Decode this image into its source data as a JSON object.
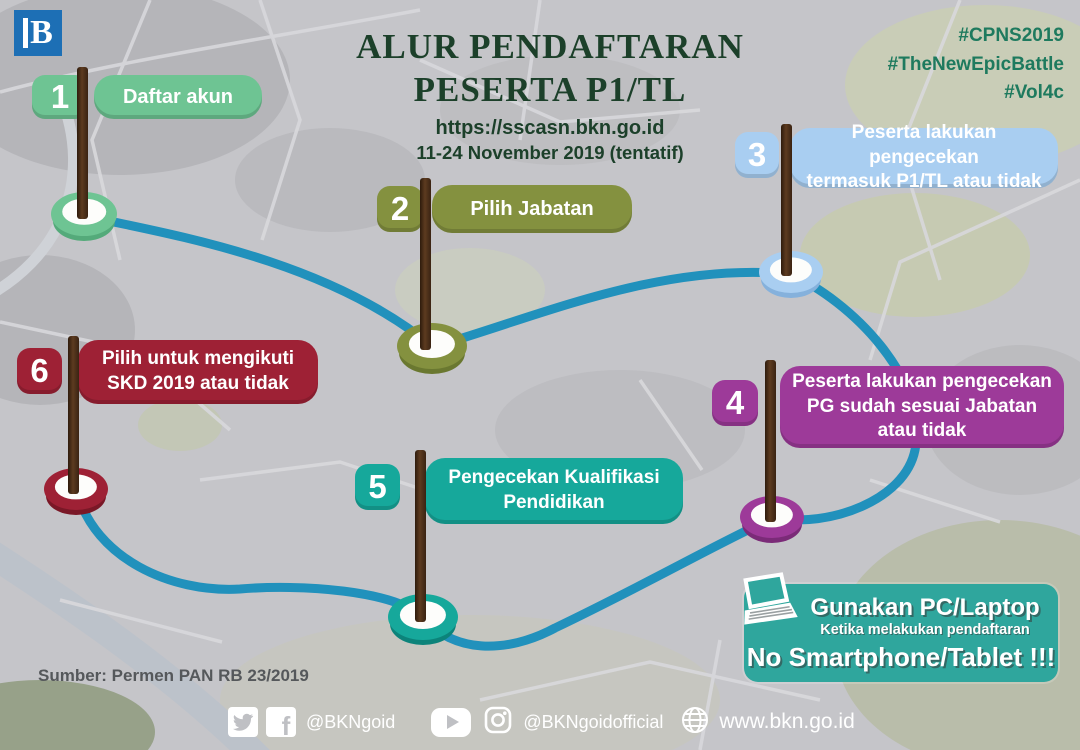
{
  "logo": {
    "letter": "B"
  },
  "header": {
    "title_line1": "ALUR PENDAFTARAN",
    "title_line2": "PESERTA P1/TL",
    "url": "https://sscasn.bkn.go.id",
    "date": "11-24 November 2019 (tentatif)"
  },
  "hashtags": {
    "tag1": "#CPNS2019",
    "tag2": "#TheNewEpicBattle",
    "tag3": "#Vol4c"
  },
  "steps": [
    {
      "number": "1",
      "label": "Daftar akun",
      "color": "#6ec493",
      "rim": "#54aa7a"
    },
    {
      "number": "2",
      "label": "Pilih Jabatan",
      "color": "#84913f",
      "rim": "#6a7830"
    },
    {
      "number": "3",
      "label": "Peserta lakukan pengecekan\ntermasuk P1/TL atau tidak",
      "color": "#a9cef1",
      "rim": "#85b1dc"
    },
    {
      "number": "4",
      "label": "Peserta lakukan pengecekan\nPG sudah sesuai Jabatan\natau tidak",
      "color": "#9d3a99",
      "rim": "#7b2b78"
    },
    {
      "number": "5",
      "label": "Pengecekan Kualifikasi\nPendidikan",
      "color": "#16a89b",
      "rim": "#0c837a"
    },
    {
      "number": "6",
      "label": "Pilih untuk mengikuti\nSKD 2019 atau tidak",
      "color": "#9e2135",
      "rim": "#7a1827"
    }
  ],
  "route_color": "#2191bc",
  "source_note": "Sumber: Permen PAN RB 23/2019",
  "notice": {
    "line1": "Gunakan PC/Laptop",
    "line2": "Ketika melakukan pendaftaran",
    "line3": "No Smartphone/Tablet !!!",
    "bg": "#2fa69d"
  },
  "footer": {
    "handle_primary": "@BKNgoid",
    "handle_secondary": "@BKNgoidofficial",
    "website": "www.bkn.go.id"
  }
}
